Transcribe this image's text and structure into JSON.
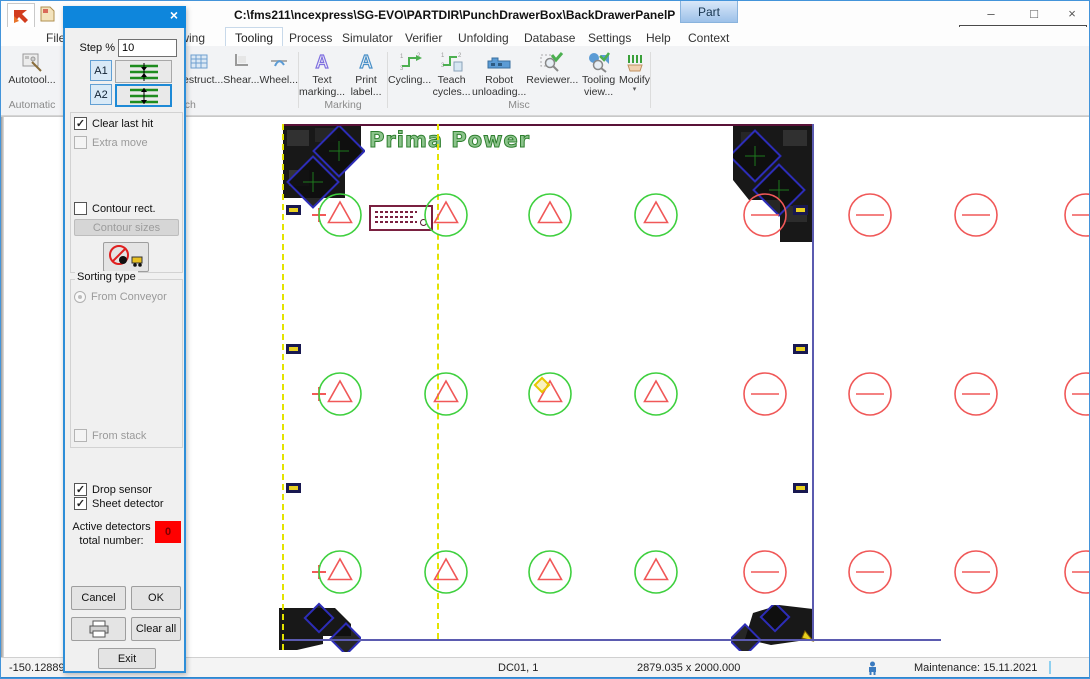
{
  "window": {
    "title": "C:\\fms211\\ncexpress\\SG-EVO\\PARTDIR\\PunchDrawerBox\\BackDrawerPanelP",
    "part_tab": "Part",
    "machine_selector": "SG-EVO"
  },
  "menu": {
    "items": [
      "File",
      "Drawing",
      "Tooling",
      "Process",
      "Simulator",
      "Verifier",
      "Unfolding",
      "Database",
      "Settings",
      "Help",
      "Context"
    ],
    "active": "Tooling"
  },
  "ribbon": {
    "groups": [
      {
        "label": "Automatic",
        "buttons": [
          {
            "label": "Autotool...",
            "icon": "autotool-icon"
          }
        ]
      },
      {
        "label": "Punch",
        "buttons": [
          {
            "label": "Destruct...",
            "icon": "destruct-icon"
          },
          {
            "label": "Shear...",
            "icon": "shear-icon"
          },
          {
            "label": "Wheel...",
            "icon": "wheel-icon"
          }
        ]
      },
      {
        "label": "Marking",
        "buttons": [
          {
            "label": "Text marking...",
            "icon": "text-marking-icon"
          },
          {
            "label": "Print label...",
            "icon": "print-label-icon"
          }
        ]
      },
      {
        "label": "Misc",
        "buttons": [
          {
            "label": "Cycling...",
            "icon": "cycling-icon"
          },
          {
            "label": "Teach cycles...",
            "icon": "teach-cycles-icon"
          },
          {
            "label": "Robot unloading...",
            "icon": "robot-unloading-icon"
          },
          {
            "label": "Reviewer...",
            "icon": "reviewer-icon"
          },
          {
            "label": "Tooling view...",
            "icon": "tooling-view-icon"
          },
          {
            "label": "Modify",
            "icon": "modify-icon"
          }
        ]
      }
    ]
  },
  "dialog": {
    "step_label": "Step %",
    "step_value": "10",
    "a1_label": "A1",
    "a2_label": "A2",
    "clear_last_hit": {
      "label": "Clear last hit",
      "checked": true
    },
    "extra_move": {
      "label": "Extra move",
      "checked": false
    },
    "contour_rect": {
      "label": "Contour rect.",
      "checked": false
    },
    "contour_sizes_label": "Contour sizes",
    "sorting_type_label": "Sorting type",
    "from_conveyor": {
      "label": "From Conveyor",
      "selected": true
    },
    "from_stack": {
      "label": "From stack",
      "checked": false
    },
    "drop_sensor": {
      "label": "Drop sensor",
      "checked": true
    },
    "sheet_detector": {
      "label": "Sheet detector",
      "checked": true
    },
    "active_detectors_label_line1": "Active detectors",
    "active_detectors_label_line2": "total number:",
    "active_detectors_value": "0",
    "cancel_label": "Cancel",
    "ok_label": "OK",
    "clear_all_label": "Clear all",
    "exit_label": "Exit"
  },
  "status_bar": {
    "coordinate": "-150.12889",
    "station": "DC01, 1",
    "sheet_size": "2879.035 x 2000.000",
    "maintenance": "Maintenance: 15.11.2021"
  },
  "canvas": {
    "logo_text": "Prima Power",
    "sheet": {
      "left": 281,
      "top": 122,
      "right": 811,
      "bottom": 637,
      "bottom_line_end": 940
    },
    "dashed_lines_x": [
      281,
      436
    ],
    "rows_y": [
      213,
      392,
      570
    ],
    "triangle_marks_x": [
      339,
      445,
      549,
      655
    ],
    "line_marks_x": [
      764,
      869,
      975,
      1085
    ],
    "plus_marks_x": 318,
    "clamp_tabs": [
      {
        "x": 285,
        "y": 208
      },
      {
        "x": 285,
        "y": 347
      },
      {
        "x": 285,
        "y": 486
      },
      {
        "x": 792,
        "y": 208
      },
      {
        "x": 792,
        "y": 347
      },
      {
        "x": 792,
        "y": 486
      }
    ],
    "highlight_diamond": {
      "x": 541,
      "y": 383
    },
    "colors": {
      "triangle_tool": "#f05858",
      "circle_tool": "#3fd03f",
      "line_tool": "#f05858",
      "sheet_edge": "#5b5bb0",
      "part_top_edge": "#5a1238",
      "dashed_line": "#e3e300",
      "highlight": "#e8c800"
    }
  }
}
